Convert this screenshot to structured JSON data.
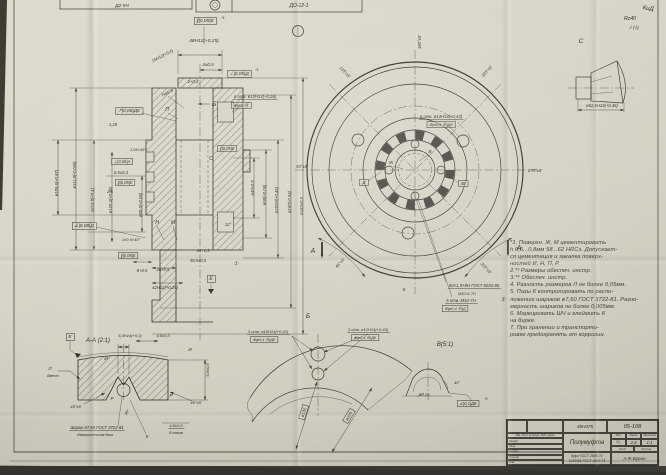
{
  "sheet": {
    "bg": "#d6d2c4",
    "ink": "#2f2e2a"
  },
  "notes": {
    "text": "*1. Поверхн. Ж, М цементировать\nh 0,5...0,8мм 58...62 HRCэ. Допускает-\nся цементация и закалка поверх-\nностей И, Н, П, Р.\n2.*³ Размеры обеспеч. инстр.\n3.*⁴ Обеспеч. инстр.\n4. Разность размеров Л не более 0,05мм.\n5. Пазы К контролировать по распо-\nложению шариков ø7,60 ГОСТ 3722-81. Разно-\nмерность шариков не более 0,005мм.\n6. Маркировать ШЧ и клеймить К\nна бирке.\n7. При хранении и транспорти-\nровке предохранять от коррозии."
  },
  "title_block": {
    "approved_code": "45Н475",
    "designation": "05-108",
    "name": "Полумуфта",
    "litera_label": "Лит.",
    "mass_label": "Масса",
    "scale_label": "Масштаб",
    "litera": "О₁",
    "mass": "2,8",
    "scale": "1:1",
    "sheet_label": "Лист",
    "sheets_label": "Листов",
    "material1": "Круг ГОСТ 2590-71",
    "material2": "12ХН3А ГОСТ 4543-71",
    "sign": "А.Ф.Бурин",
    "rows": [
      "Изм. Лист № докум. Подп. Дата",
      "Разраб.",
      "Пров.",
      "Т.контр.",
      "Н.контр.",
      "Утв."
    ]
  },
  "annotations": [
    {
      "n": "stamp-left-code",
      "t": "Д2-5Ч",
      "x": 122,
      "y": 7,
      "s": 4.8
    },
    {
      "n": "stamp-box-code",
      "t": "ДО-12-1",
      "x": 299,
      "y": 7,
      "s": 5
    },
    {
      "n": "frame-parallel-e-top",
      "t": "∥|0,05|Е",
      "x": 205,
      "y": 22,
      "b": 1,
      "s": 4.8
    },
    {
      "n": "footnote-1a",
      "t": "*1",
      "x": 223,
      "y": 19,
      "s": 3.8
    },
    {
      "n": "dim-48h12",
      "t": "48Н12(+0,25)",
      "x": 204,
      "y": 42,
      "s": 4.8
    },
    {
      "n": "dim-4",
      "t": "4±0,5",
      "x": 208,
      "y": 66,
      "s": 4.5
    },
    {
      "n": "dim-2",
      "t": "2+0,3",
      "x": 193,
      "y": 83,
      "s": 4.2
    },
    {
      "n": "frame-perp-d",
      "t": "⊥|0,05|Д",
      "x": 239,
      "y": 75,
      "b": 1,
      "s": 4.8
    },
    {
      "n": "footnote-1b",
      "t": "*1",
      "x": 257,
      "y": 71,
      "s": 3.8
    },
    {
      "n": "dim-15h12",
      "t": "15Н12(+0,4)",
      "x": 163,
      "y": 57,
      "r": -28,
      "s": 4.2
    },
    {
      "n": "dim-ra5",
      "t": "Ra5*3",
      "x": 168,
      "y": 94,
      "r": -25,
      "s": 4.2
    },
    {
      "n": "view-arrow-b",
      "t": "Б",
      "x": 214,
      "y": 106,
      "s": 6.5
    },
    {
      "n": "dim-6otv-10",
      "t": "6 отв. ø10Н14(+0,26)",
      "x": 255,
      "y": 98,
      "s": 4.2,
      "u": 1
    },
    {
      "n": "frame-pos-1",
      "t": "⊕|ø1 Ⓜ",
      "x": 241,
      "y": 107,
      "b": 1,
      "s": 4.2
    },
    {
      "n": "frame-runout",
      "t": "↗|0,08|ДЕ",
      "x": 129,
      "y": 112,
      "b": 1,
      "s": 4.8
    },
    {
      "n": "label-p",
      "t": "П",
      "x": 167,
      "y": 111,
      "s": 5
    },
    {
      "n": "dim-125",
      "t": "1,25",
      "x": 113,
      "y": 126,
      "s": 4.2
    },
    {
      "n": "dim-105x45",
      "t": "1,05×45°",
      "x": 138,
      "y": 151,
      "s": 4
    },
    {
      "n": "label-s",
      "t": "С",
      "x": 211,
      "y": 160,
      "s": 5
    },
    {
      "n": "frame-par-e2",
      "t": "∥|0,05|Е",
      "x": 227,
      "y": 150,
      "b": 1,
      "s": 4.2
    },
    {
      "n": "frame-perp-a",
      "t": "⊥|0,06|А",
      "x": 122,
      "y": 163,
      "b": 1,
      "s": 4.2
    },
    {
      "n": "dim-85",
      "t": "8,5±0,3",
      "x": 121,
      "y": 174,
      "s": 4.2
    },
    {
      "n": "frame-par-e3",
      "t": "∥|0,05|Е",
      "x": 125,
      "y": 184,
      "b": 1,
      "s": 4.2
    },
    {
      "n": "dim-25r",
      "t": "2,5",
      "x": 110,
      "y": 193,
      "s": 4.2
    },
    {
      "n": "frame-ang-d",
      "t": "∠|0,08|Д",
      "x": 84,
      "y": 227,
      "b": 1,
      "s": 4.8
    },
    {
      "n": "label-n",
      "t": "Н",
      "x": 157,
      "y": 224,
      "s": 5
    },
    {
      "n": "label-m",
      "t": "М",
      "x": 173,
      "y": 224,
      "s": 5
    },
    {
      "n": "dim-12deg",
      "t": "12°",
      "x": 228,
      "y": 226,
      "s": 4.2
    },
    {
      "n": "dim-1x45",
      "t": "1±0,5×45°",
      "x": 131,
      "y": 241,
      "s": 4
    },
    {
      "n": "frame-par-e4",
      "t": "∥|0,05|Е",
      "x": 128,
      "y": 257,
      "b": 1,
      "s": 4.2
    },
    {
      "n": "dim-8",
      "t": "8+0,5",
      "x": 142,
      "y": 272,
      "s": 4.2
    },
    {
      "n": "dim-20",
      "t": "20+0,5",
      "x": 163,
      "y": 271,
      "s": 4.2
    },
    {
      "n": "dim-42h12",
      "t": "42Н12(+0,25)",
      "x": 165,
      "y": 289,
      "s": 4.2
    },
    {
      "n": "dim-48",
      "t": "48+1,5",
      "x": 203,
      "y": 252,
      "s": 4.2
    },
    {
      "n": "dim-385",
      "t": "38,5±0,5",
      "x": 198,
      "y": 262,
      "s": 4.2
    },
    {
      "n": "note-ref-1",
      "t": "①",
      "x": 236,
      "y": 265,
      "s": 5
    },
    {
      "n": "datum-e-flag",
      "t": "Е",
      "x": 211,
      "y": 280,
      "b": 1,
      "s": 5
    },
    {
      "n": "dim-d1056",
      "t": "ø105,6(+0,87)",
      "x": 58,
      "y": 183,
      "r": -90,
      "s": 4.2
    },
    {
      "n": "dim-d1118",
      "t": "ø111,8(-0,045)",
      "x": 76,
      "y": 175,
      "r": -90,
      "s": 4.2
    },
    {
      "n": "dim-d1148",
      "t": "ø114,8(+0,4)",
      "x": 94,
      "y": 200,
      "r": -90,
      "s": 4.2
    },
    {
      "n": "dim-d1204",
      "t": "ø120,4(+0,46)",
      "x": 112,
      "y": 200,
      "r": -90,
      "s": 4.2
    },
    {
      "n": "dim-d605",
      "t": "ø60,5(+0,06)",
      "x": 142,
      "y": 205,
      "r": -90,
      "s": 4.2
    },
    {
      "n": "dim-d40",
      "t": "ø40±0,5",
      "x": 254,
      "y": 188,
      "r": -90,
      "s": 4.2
    },
    {
      "n": "dim-d58",
      "t": "ø58(+0,06)",
      "x": 266,
      "y": 195,
      "r": -90,
      "s": 4.2
    },
    {
      "n": "dim-d105",
      "t": "ø105Н(+0,46)",
      "x": 278,
      "y": 200,
      "r": -90,
      "s": 4.2
    },
    {
      "n": "dim-d160",
      "t": "ø160(-0,04)",
      "x": 291,
      "y": 202,
      "r": -90,
      "s": 4.2
    },
    {
      "n": "dim-d162",
      "t": "ø162±0,5",
      "x": 303,
      "y": 206,
      "r": -90,
      "s": 4.2
    },
    {
      "n": "angle-180",
      "t": "180°±5′",
      "x": 421,
      "y": 42,
      "r": -90,
      "s": 4.2
    },
    {
      "n": "angle-225",
      "t": "225°±5′",
      "x": 488,
      "y": 72,
      "r": -47,
      "s": 4.2
    },
    {
      "n": "angle-270",
      "t": "270°±5′",
      "x": 535,
      "y": 172,
      "s": 4.2
    },
    {
      "n": "angle-315",
      "t": "315°±5′",
      "x": 485,
      "y": 269,
      "r": 47,
      "s": 4.2
    },
    {
      "n": "angle-0",
      "t": "0",
      "x": 404,
      "y": 291,
      "s": 4.5
    },
    {
      "n": "angle-45",
      "t": "45°±5′",
      "x": 341,
      "y": 264,
      "r": -47,
      "s": 4.2
    },
    {
      "n": "angle-90",
      "t": "90°±5′",
      "x": 302,
      "y": 168,
      "s": 4.2
    },
    {
      "n": "angle-135",
      "t": "135°±5′",
      "x": 344,
      "y": 73,
      "r": 47,
      "s": 4.2
    },
    {
      "n": "section-a-left",
      "t": "А",
      "x": 313,
      "y": 253,
      "s": 7
    },
    {
      "n": "section-a-right",
      "t": "А",
      "x": 519,
      "y": 250,
      "s": 7
    },
    {
      "n": "dim-6otv-13",
      "t": "6 отв. ø13Н14(+0,43)",
      "x": 441,
      "y": 118,
      "s": 4.2,
      "u": 1
    },
    {
      "n": "frame-pos-13",
      "t": "⊕|ø0,5 Ⓜ|ДЕ",
      "x": 441,
      "y": 126,
      "b": 1,
      "s": 4
    },
    {
      "n": "label-v",
      "t": "В",
      "x": 430,
      "y": 153,
      "s": 4.8
    },
    {
      "n": "label-zh",
      "t": "Ж",
      "x": 391,
      "y": 164,
      "s": 4.8
    },
    {
      "n": "datum-d-flag",
      "t": "Д",
      "x": 364,
      "y": 184,
      "b": 1,
      "s": 4.5
    },
    {
      "n": "dim-48-box",
      "t": "48",
      "x": 463,
      "y": 185,
      "b": 1,
      "s": 4.5
    },
    {
      "n": "note-spline",
      "t": "50×1,5×9Н ГОСТ 6033-80",
      "x": 474,
      "y": 287,
      "s": 4.3,
      "u": 1
    },
    {
      "n": "note-thread",
      "t": "М10×1-7Н",
      "x": 467,
      "y": 295,
      "s": 3.8
    },
    {
      "n": "note-5otv",
      "t": "5 отв. М10-7Н",
      "x": 461,
      "y": 302,
      "s": 4.3,
      "u": 1
    },
    {
      "n": "frame-pos-m10",
      "t": "⊕|ø0,4 Ⓜ|Д",
      "x": 455,
      "y": 310,
      "b": 1,
      "s": 4
    },
    {
      "n": "note-ref-2",
      "t": "①",
      "x": 503,
      "y": 301,
      "s": 5
    },
    {
      "n": "label-c-view",
      "t": "С",
      "x": 581,
      "y": 43,
      "s": 6.5
    },
    {
      "n": "dim-d626",
      "t": "ø62,6Н13(+0,46)",
      "x": 602,
      "y": 107,
      "s": 4.2
    },
    {
      "n": "roughness-general",
      "t": "Rz40",
      "x": 630,
      "y": 20,
      "s": 5.2
    },
    {
      "n": "roughness-checks",
      "t": "√ (√)",
      "x": 634,
      "y": 29,
      "s": 4.5
    },
    {
      "n": "pencil-mark",
      "t": "КиД",
      "x": 648,
      "y": 10,
      "r": 8,
      "s": 6,
      "c": "#55524c"
    },
    {
      "n": "label-aa",
      "t": "А-А (2:1)",
      "x": 98,
      "y": 342,
      "s": 6
    },
    {
      "n": "datum-e-flag2",
      "t": "Е",
      "x": 70,
      "y": 338,
      "b": 1,
      "s": 4.8
    },
    {
      "n": "label-l",
      "t": "Л",
      "x": 50,
      "y": 370,
      "s": 4.5
    },
    {
      "n": "label-vmest",
      "t": "Вмест",
      "x": 53,
      "y": 377,
      "s": 3.6
    },
    {
      "n": "dim-53h14",
      "t": "5,3Н14(+0,3)",
      "x": 130,
      "y": 337,
      "s": 4
    },
    {
      "n": "dim-45-03",
      "t": "4,5±0,3",
      "x": 163,
      "y": 337,
      "s": 4
    },
    {
      "n": "dim-65",
      "t": "6,5±0,5",
      "x": 209,
      "y": 370,
      "r": -90,
      "s": 4
    },
    {
      "n": "dim-45deg-l",
      "t": "45°±5′",
      "x": 76,
      "y": 408,
      "s": 4
    },
    {
      "n": "dim-45deg-r",
      "t": "45°±5′",
      "x": 196,
      "y": 404,
      "s": 4
    },
    {
      "n": "dim-30deg",
      "t": "30°",
      "x": 128,
      "y": 413,
      "r": -55,
      "s": 3.8
    },
    {
      "n": "label-i1",
      "t": "И",
      "x": 106,
      "y": 360,
      "s": 4.6
    },
    {
      "n": "label-i2",
      "t": "И",
      "x": 190,
      "y": 351,
      "s": 4.6
    },
    {
      "n": "label-r1",
      "t": "Р",
      "x": 112,
      "y": 400,
      "s": 4.6
    },
    {
      "n": "label-r2",
      "t": "Р",
      "x": 171,
      "y": 397,
      "s": 4.6
    },
    {
      "n": "label-k",
      "t": "К",
      "x": 147,
      "y": 438,
      "s": 4.6
    },
    {
      "n": "note-ball",
      "t": "Шарик ø7,60 ГОСТ 3722-81",
      "x": 97,
      "y": 429,
      "s": 4.2,
      "u": 1
    },
    {
      "n": "note-base",
      "t": "Измерительная база",
      "x": 95,
      "y": 436,
      "s": 3.6
    },
    {
      "n": "dim-45-05",
      "t": "4,5±0,5",
      "x": 176,
      "y": 427,
      "s": 4,
      "u": 1
    },
    {
      "n": "note-8pazov",
      "t": "8 пазов",
      "x": 176,
      "y": 434,
      "s": 4
    },
    {
      "n": "label-b-view",
      "t": "Б",
      "x": 308,
      "y": 318,
      "s": 6.5
    },
    {
      "n": "dim-3otv10",
      "t": "3 отв. ø10Н14(+0,43)",
      "x": 268,
      "y": 333,
      "s": 4,
      "u": 1
    },
    {
      "n": "frame-pos-b1",
      "t": "⊕|ø0,4 Ⓜ|ДЕ",
      "x": 264,
      "y": 341,
      "b": 1,
      "s": 3.8
    },
    {
      "n": "dim-3otv12",
      "t": "3 отв. ø12Н14(+0,43)",
      "x": 368,
      "y": 331,
      "s": 4,
      "u": 1
    },
    {
      "n": "frame-pos-b2",
      "t": "⊕|ø0,4 Ⓜ|ДЕ",
      "x": 365,
      "y": 339,
      "b": 1,
      "s": 3.8
    },
    {
      "n": "dim-d135",
      "t": "ø135",
      "x": 305,
      "y": 413,
      "r": -73,
      "b": 1,
      "s": 4.2
    },
    {
      "n": "dim-d225",
      "t": "ø225",
      "x": 350,
      "y": 417,
      "r": -58,
      "b": 1,
      "s": 4.2
    },
    {
      "n": "label-v-view",
      "t": "В(5:1)",
      "x": 445,
      "y": 346,
      "s": 6
    },
    {
      "n": "dim-r029",
      "t": "R0,29",
      "x": 424,
      "y": 396,
      "s": 4
    },
    {
      "n": "dim-45deg-v",
      "t": "45°",
      "x": 457,
      "y": 384,
      "s": 3.8
    },
    {
      "n": "frame-ang-de",
      "t": "∠|0,1|ДЕ",
      "x": 468,
      "y": 405,
      "b": 1,
      "s": 4.2
    },
    {
      "n": "footnote-1c",
      "t": "*1",
      "x": 486,
      "y": 400,
      "s": 3.6
    }
  ]
}
